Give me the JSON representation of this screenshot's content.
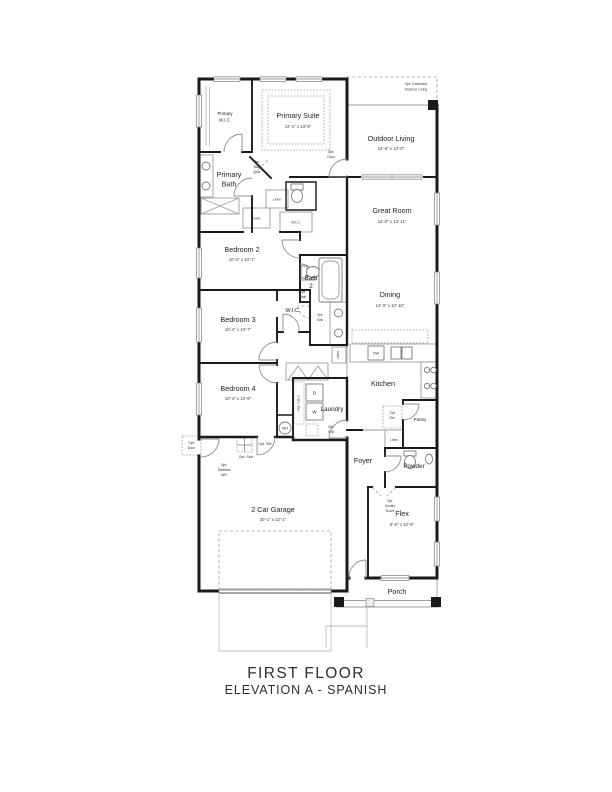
{
  "title": {
    "line1": "FIRST FLOOR",
    "line2": "ELEVATION A - SPANISH"
  },
  "rooms": {
    "primary_wic": {
      "l1": "Primary",
      "l2": "W.I.C."
    },
    "primary_suite": {
      "name": "Primary Suite",
      "dims": "12'-1\" x 13'-6\""
    },
    "primary_bath": {
      "l1": "Primary",
      "l2": "Bath"
    },
    "outdoor_living": {
      "name": "Outdoor Living",
      "dims": "14'-6\" x 10'-0\""
    },
    "great_room": {
      "name": "Great Room",
      "dims": "14'-0\" x 13'-11\""
    },
    "dining": {
      "name": "Dining",
      "dims": "14'-0\" x 10'-10\""
    },
    "kitchen": {
      "name": "Kitchen"
    },
    "bedroom2": {
      "name": "Bedroom 2",
      "dims": "10'-4\" x 10'-1\""
    },
    "bedroom3": {
      "name": "Bedroom 3",
      "dims": "10'-4\" x 10'-7\""
    },
    "bedroom4": {
      "name": "Bedroom 4",
      "dims": "10'-4\" x 10'-8\""
    },
    "bath2": {
      "l1": "Bath",
      "l2": "2"
    },
    "wic": {
      "name": "W.I.C."
    },
    "laundry": {
      "name": "Laundry"
    },
    "foyer": {
      "name": "Foyer"
    },
    "powder": {
      "name": "Powder"
    },
    "pantry": {
      "name": "Pantry"
    },
    "flex": {
      "name": "Flex",
      "dims": "9'-6\" x 10'-9\""
    },
    "garage": {
      "name": "2 Car Garage",
      "dims": "20'-1\" x 22'-1\""
    },
    "porch": {
      "name": "Porch"
    }
  },
  "ann": {
    "opt_extended_l1": "Opt. Extended",
    "opt_extended_l2": "Outdoor Living",
    "opt": "Opt.",
    "door": "Door",
    "bath": "Bath",
    "sink": "Sink",
    "linen": "Linen",
    "opt_cabs": "Opt. Cab.s",
    "opt_sink": "Opt. Sink",
    "opt_sw": "Opt. SW",
    "tankless": "Tankless",
    "wh": "WH",
    "ref": "Ref.",
    "double": "Double",
    "doors": "Doors",
    "dw": "DW",
    "d": "D",
    "w": "W"
  },
  "colors": {
    "wall": "#1a1a1a",
    "thin_line": "#9c9c9c",
    "text": "#1c1c1c"
  }
}
